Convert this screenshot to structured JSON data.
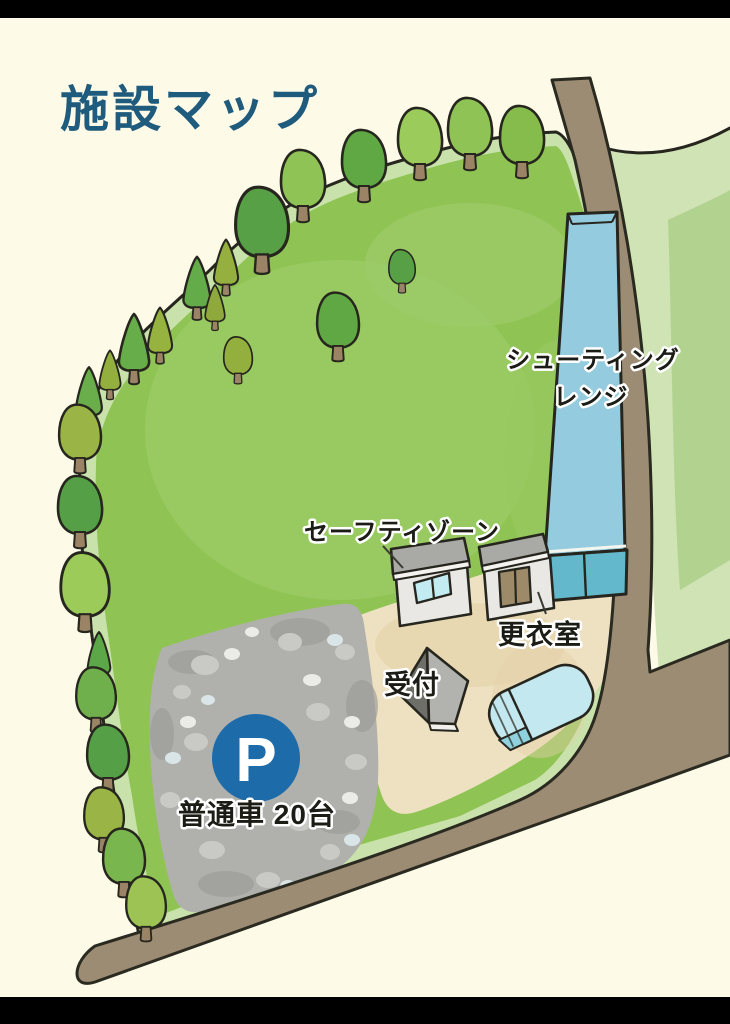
{
  "page": {
    "title": "施設マップ"
  },
  "map": {
    "labels": {
      "shooting_range_line1": "シューティング",
      "shooting_range_line2": "レンジ",
      "safety_zone": "セーフティゾーン",
      "changing_room": "更衣室",
      "reception": "受付",
      "parking_symbol": "P",
      "parking_capacity": "普通車 20台"
    },
    "colors": {
      "title_blue": "#1f5b7d",
      "background_cream": "#fdfae8",
      "field_green": "#8fc455",
      "field_light_green": "#9ccb68",
      "field_pale_edge": "#c9e2ab",
      "right_area_pale": "#cfe3b4",
      "road_brown": "#9c8c73",
      "shooting_range_blue": "#95cbde",
      "range_end_teal": "#64b8cc",
      "ground_tan": "#eee1c2",
      "parking_gray": "#b0b0ac",
      "parking_badge_blue": "#1d6ca9",
      "building_gray": "#e9e8e4",
      "roof_gray": "#a9a9a5",
      "door_brown": "#9c8a68",
      "outline_black": "#26261e"
    }
  }
}
